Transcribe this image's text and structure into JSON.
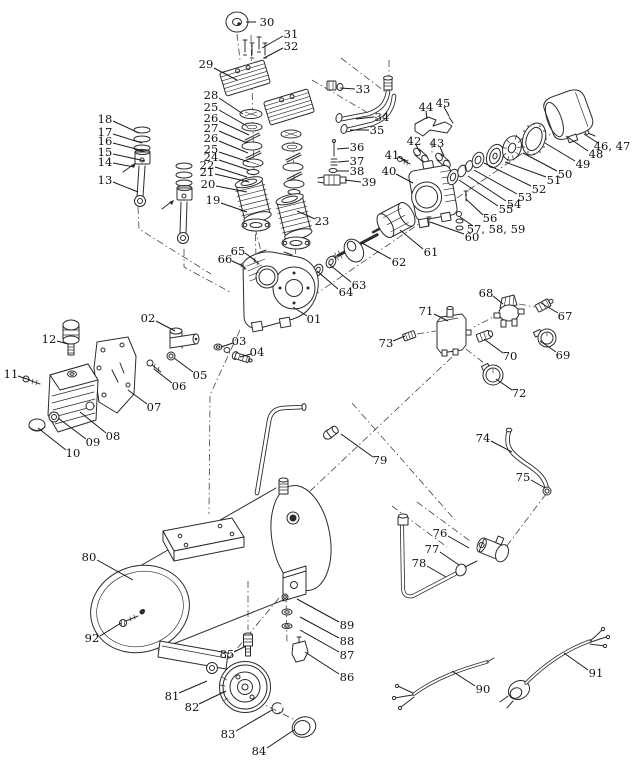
{
  "diagram": {
    "type": "exploded-parts-diagram",
    "subject": "Air compressor exploded parts view",
    "canvas": {
      "width": 640,
      "height": 768,
      "background": "#ffffff"
    },
    "style": {
      "line_color": "#2b2b2b",
      "label_color": "#111111",
      "leader_color": "#1a1a1a",
      "label_font_size": 11.5
    },
    "callouts": [
      {
        "t": "30",
        "x": 267,
        "y": 22,
        "l": [
          256,
          22,
          246,
          22
        ]
      },
      {
        "t": "31",
        "x": 291,
        "y": 34,
        "l": [
          283,
          36,
          262,
          48
        ]
      },
      {
        "t": "32",
        "x": 291,
        "y": 46,
        "l": [
          283,
          48,
          264,
          58
        ]
      },
      {
        "t": "29",
        "x": 206,
        "y": 64,
        "l": [
          214,
          68,
          237,
          80
        ]
      },
      {
        "t": "33",
        "x": 363,
        "y": 89,
        "l": [
          355,
          89,
          340,
          88
        ]
      },
      {
        "t": "34",
        "x": 382,
        "y": 117,
        "l": [
          374,
          117,
          356,
          119
        ]
      },
      {
        "t": "35",
        "x": 377,
        "y": 130,
        "l": [
          369,
          130,
          350,
          130
        ]
      },
      {
        "t": "28",
        "x": 211,
        "y": 95,
        "l": [
          219,
          98,
          243,
          114
        ]
      },
      {
        "t": "25",
        "x": 211,
        "y": 107,
        "l": [
          219,
          110,
          247,
          126
        ]
      },
      {
        "t": "26",
        "x": 211,
        "y": 118,
        "l": [
          219,
          121,
          249,
          135
        ]
      },
      {
        "t": "27",
        "x": 211,
        "y": 128,
        "l": [
          219,
          131,
          247,
          143
        ]
      },
      {
        "t": "26",
        "x": 211,
        "y": 138,
        "l": [
          219,
          141,
          248,
          153
        ]
      },
      {
        "t": "25",
        "x": 211,
        "y": 149,
        "l": [
          219,
          152,
          249,
          162
        ]
      },
      {
        "t": "24",
        "x": 211,
        "y": 157,
        "l": [
          219,
          160,
          249,
          170
        ]
      },
      {
        "t": "22",
        "x": 207,
        "y": 165,
        "l": [
          215,
          167,
          247,
          177
        ]
      },
      {
        "t": "21",
        "x": 207,
        "y": 172,
        "l": [
          215,
          174,
          249,
          182
        ]
      },
      {
        "t": "20",
        "x": 208,
        "y": 184,
        "l": [
          216,
          186,
          247,
          192
        ]
      },
      {
        "t": "19",
        "x": 213,
        "y": 200,
        "l": [
          221,
          203,
          247,
          212
        ]
      },
      {
        "t": "23",
        "x": 322,
        "y": 221,
        "l": [
          315,
          219,
          297,
          211
        ]
      },
      {
        "t": "18",
        "x": 105,
        "y": 119,
        "l": [
          113,
          121,
          139,
          133
        ]
      },
      {
        "t": "17",
        "x": 105,
        "y": 132,
        "l": [
          113,
          134,
          142,
          143
        ]
      },
      {
        "t": "16",
        "x": 105,
        "y": 141,
        "l": [
          113,
          143,
          144,
          151
        ]
      },
      {
        "t": "15",
        "x": 105,
        "y": 152,
        "l": [
          113,
          154,
          145,
          161
        ]
      },
      {
        "t": "14",
        "x": 105,
        "y": 162,
        "l": [
          113,
          163,
          134,
          167
        ]
      },
      {
        "t": "13",
        "x": 105,
        "y": 180,
        "l": [
          113,
          182,
          138,
          192
        ]
      },
      {
        "t": "36",
        "x": 357,
        "y": 147,
        "l": [
          349,
          148,
          337,
          149
        ]
      },
      {
        "t": "37",
        "x": 357,
        "y": 161,
        "l": [
          349,
          161,
          338,
          162
        ]
      },
      {
        "t": "38",
        "x": 357,
        "y": 171,
        "l": [
          349,
          171,
          337,
          171
        ]
      },
      {
        "t": "39",
        "x": 369,
        "y": 182,
        "l": [
          361,
          182,
          345,
          180
        ]
      },
      {
        "t": "44",
        "x": 426,
        "y": 107,
        "l": [
          426,
          111,
          427,
          119
        ]
      },
      {
        "t": "45",
        "x": 443,
        "y": 103,
        "l": [
          444,
          107,
          449,
          116
        ]
      },
      {
        "t": "42",
        "x": 414,
        "y": 141,
        "l": [
          416,
          145,
          420,
          152
        ]
      },
      {
        "t": "43",
        "x": 437,
        "y": 143,
        "l": [
          440,
          147,
          444,
          156
        ]
      },
      {
        "t": "41",
        "x": 392,
        "y": 155,
        "l": [
          398,
          157,
          407,
          161
        ]
      },
      {
        "t": "40",
        "x": 389,
        "y": 171,
        "l": [
          396,
          174,
          413,
          183
        ]
      },
      {
        "t": "46, 47",
        "x": 612,
        "y": 146,
        "l": [
          598,
          143,
          584,
          134
        ]
      },
      {
        "t": "48",
        "x": 596,
        "y": 154,
        "l": [
          588,
          151,
          566,
          136
        ]
      },
      {
        "t": "49",
        "x": 583,
        "y": 164,
        "l": [
          575,
          161,
          545,
          143
        ]
      },
      {
        "t": "50",
        "x": 565,
        "y": 174,
        "l": [
          557,
          171,
          523,
          153
        ]
      },
      {
        "t": "51",
        "x": 554,
        "y": 180,
        "l": [
          546,
          177,
          505,
          162
        ]
      },
      {
        "t": "52",
        "x": 539,
        "y": 189,
        "l": [
          531,
          186,
          484,
          163
        ]
      },
      {
        "t": "53",
        "x": 525,
        "y": 197,
        "l": [
          517,
          194,
          474,
          170
        ]
      },
      {
        "t": "54",
        "x": 514,
        "y": 204,
        "l": [
          506,
          201,
          468,
          176
        ]
      },
      {
        "t": "55",
        "x": 506,
        "y": 209,
        "l": [
          498,
          206,
          459,
          180
        ]
      },
      {
        "t": "56",
        "x": 490,
        "y": 218,
        "l": [
          483,
          215,
          466,
          199
        ]
      },
      {
        "t": "57, 58, 59",
        "x": 496,
        "y": 229,
        "l": [
          473,
          226,
          460,
          217
        ]
      },
      {
        "t": "60",
        "x": 472,
        "y": 237,
        "l": [
          464,
          234,
          430,
          222
        ]
      },
      {
        "t": "61",
        "x": 431,
        "y": 252,
        "l": [
          423,
          249,
          400,
          230
        ]
      },
      {
        "t": "62",
        "x": 399,
        "y": 262,
        "l": [
          391,
          259,
          362,
          243
        ]
      },
      {
        "t": "63",
        "x": 359,
        "y": 285,
        "l": [
          351,
          282,
          330,
          265
        ]
      },
      {
        "t": "64",
        "x": 346,
        "y": 292,
        "l": [
          338,
          289,
          317,
          271
        ]
      },
      {
        "t": "65",
        "x": 238,
        "y": 251,
        "l": [
          245,
          253,
          256,
          261
        ]
      },
      {
        "t": "66",
        "x": 225,
        "y": 259,
        "l": [
          232,
          261,
          243,
          266
        ]
      },
      {
        "t": "01",
        "x": 314,
        "y": 319,
        "l": [
          307,
          316,
          293,
          307
        ]
      },
      {
        "t": "02",
        "x": 148,
        "y": 318,
        "l": [
          156,
          321,
          175,
          331
        ]
      },
      {
        "t": "03",
        "x": 239,
        "y": 341,
        "l": [
          233,
          343,
          221,
          347
        ]
      },
      {
        "t": "04",
        "x": 257,
        "y": 352,
        "l": [
          251,
          354,
          240,
          357
        ]
      },
      {
        "t": "12",
        "x": 49,
        "y": 339,
        "l": [
          57,
          341,
          68,
          344
        ]
      },
      {
        "t": "11",
        "x": 11,
        "y": 374,
        "l": [
          18,
          376,
          30,
          380
        ]
      },
      {
        "t": "05",
        "x": 200,
        "y": 375,
        "l": [
          193,
          372,
          174,
          358
        ]
      },
      {
        "t": "06",
        "x": 179,
        "y": 386,
        "l": [
          172,
          383,
          154,
          369
        ]
      },
      {
        "t": "07",
        "x": 154,
        "y": 407,
        "l": [
          147,
          404,
          128,
          390
        ]
      },
      {
        "t": "08",
        "x": 113,
        "y": 436,
        "l": [
          106,
          433,
          80,
          412
        ]
      },
      {
        "t": "09",
        "x": 93,
        "y": 442,
        "l": [
          86,
          439,
          58,
          418
        ]
      },
      {
        "t": "10",
        "x": 73,
        "y": 453,
        "l": [
          66,
          450,
          38,
          428
        ]
      },
      {
        "t": "68",
        "x": 486,
        "y": 293,
        "l": [
          493,
          296,
          503,
          304
        ]
      },
      {
        "t": "67",
        "x": 565,
        "y": 316,
        "l": [
          558,
          313,
          541,
          303
        ]
      },
      {
        "t": "71",
        "x": 426,
        "y": 311,
        "l": [
          434,
          314,
          448,
          321
        ]
      },
      {
        "t": "73",
        "x": 386,
        "y": 343,
        "l": [
          393,
          341,
          405,
          336
        ]
      },
      {
        "t": "70",
        "x": 510,
        "y": 356,
        "l": [
          503,
          353,
          484,
          339
        ]
      },
      {
        "t": "69",
        "x": 563,
        "y": 355,
        "l": [
          556,
          352,
          540,
          341
        ]
      },
      {
        "t": "72",
        "x": 519,
        "y": 393,
        "l": [
          512,
          390,
          496,
          379
        ]
      },
      {
        "t": "79",
        "x": 380,
        "y": 460,
        "l": [
          373,
          457,
          341,
          434
        ]
      },
      {
        "t": "74",
        "x": 483,
        "y": 438,
        "l": [
          491,
          441,
          512,
          452
        ]
      },
      {
        "t": "75",
        "x": 523,
        "y": 477,
        "l": [
          531,
          480,
          545,
          488
        ]
      },
      {
        "t": "76",
        "x": 440,
        "y": 533,
        "l": [
          448,
          536,
          469,
          548
        ]
      },
      {
        "t": "77",
        "x": 432,
        "y": 549,
        "l": [
          440,
          552,
          459,
          565
        ]
      },
      {
        "t": "78",
        "x": 419,
        "y": 563,
        "l": [
          427,
          566,
          446,
          577
        ]
      },
      {
        "t": "80",
        "x": 89,
        "y": 557,
        "l": [
          97,
          560,
          133,
          580
        ]
      },
      {
        "t": "92",
        "x": 92,
        "y": 638,
        "l": [
          100,
          636,
          121,
          623
        ]
      },
      {
        "t": "85",
        "x": 227,
        "y": 654,
        "l": [
          234,
          652,
          246,
          646
        ]
      },
      {
        "t": "89",
        "x": 347,
        "y": 625,
        "l": [
          339,
          622,
          297,
          599
        ]
      },
      {
        "t": "88",
        "x": 347,
        "y": 641,
        "l": [
          339,
          638,
          300,
          617
        ]
      },
      {
        "t": "87",
        "x": 347,
        "y": 655,
        "l": [
          339,
          652,
          300,
          630
        ]
      },
      {
        "t": "86",
        "x": 347,
        "y": 677,
        "l": [
          339,
          674,
          305,
          652
        ]
      },
      {
        "t": "81",
        "x": 172,
        "y": 696,
        "l": [
          179,
          693,
          207,
          681
        ]
      },
      {
        "t": "82",
        "x": 192,
        "y": 707,
        "l": [
          199,
          704,
          226,
          691
        ]
      },
      {
        "t": "83",
        "x": 228,
        "y": 734,
        "l": [
          236,
          731,
          272,
          710
        ]
      },
      {
        "t": "84",
        "x": 259,
        "y": 751,
        "l": [
          267,
          748,
          294,
          730
        ]
      },
      {
        "t": "90",
        "x": 483,
        "y": 689,
        "l": [
          475,
          686,
          452,
          671
        ]
      },
      {
        "t": "91",
        "x": 596,
        "y": 673,
        "l": [
          588,
          670,
          564,
          653
        ]
      }
    ]
  }
}
